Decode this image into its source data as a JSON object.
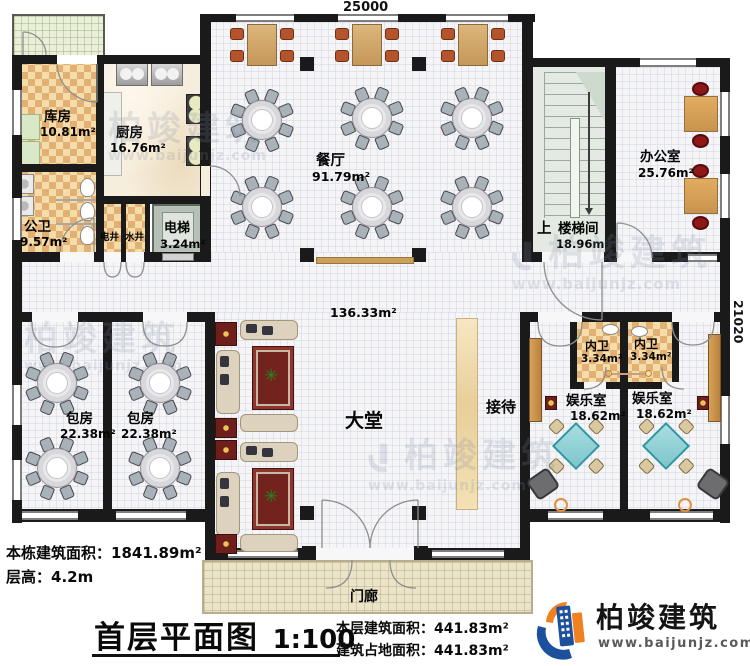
{
  "dimensions": {
    "top_width": "25000",
    "right_height": "21020"
  },
  "rooms": {
    "storage": {
      "label": "库房",
      "area": "10.81m²"
    },
    "kitchen": {
      "label": "厨房",
      "area": "16.76m²"
    },
    "dining": {
      "label": "餐厅",
      "area": "91.79m²"
    },
    "public_wc": {
      "label": "公卫",
      "area": "9.57m²"
    },
    "electric_shaft": {
      "label": "电井"
    },
    "water_shaft": {
      "label": "水井"
    },
    "elevator": {
      "label": "电梯",
      "area": "3.24m²"
    },
    "stairwell": {
      "up": "上",
      "label": "楼梯间",
      "area": "18.96m²"
    },
    "office": {
      "label": "办公室",
      "area": "25.76m²"
    },
    "lobby": {
      "label": "大堂",
      "area": "136.33m²"
    },
    "reception": {
      "label": "接待"
    },
    "private_room_1": {
      "label": "包房",
      "area": "22.38m²"
    },
    "private_room_2": {
      "label": "包房",
      "area": "22.38m²"
    },
    "inner_wc_1": {
      "label": "内卫",
      "area": "3.34m²"
    },
    "inner_wc_2": {
      "label": "内卫",
      "area": "3.34m²"
    },
    "game_room_1": {
      "label": "娱乐室",
      "area": "18.62m²"
    },
    "game_room_2": {
      "label": "娱乐室",
      "area": "18.62m²"
    },
    "porch": {
      "label": "门廊"
    }
  },
  "footer": {
    "building_area_label": "本栋建筑面积：",
    "building_area_value": "1841.89m²",
    "floor_height_label": "层高：",
    "floor_height_value": "4.2m",
    "plan_title": "首层平面图",
    "plan_scale": "1:100",
    "floor_area_label": "本层建筑面积：",
    "floor_area_value": "441.83m²",
    "footprint_label": "建筑占地面积：",
    "footprint_value": "441.83m²"
  },
  "branding": {
    "company": "柏竣建筑",
    "website": "www.baijunjz.com"
  },
  "watermark": {
    "company": "柏竣建筑",
    "website": "www.baijunjz.com"
  },
  "icons": {
    "plant": "✳"
  },
  "colors": {
    "logo_blue": "#1c4f9c",
    "logo_orange": "#f08020",
    "wall": "#1a1a1a"
  }
}
